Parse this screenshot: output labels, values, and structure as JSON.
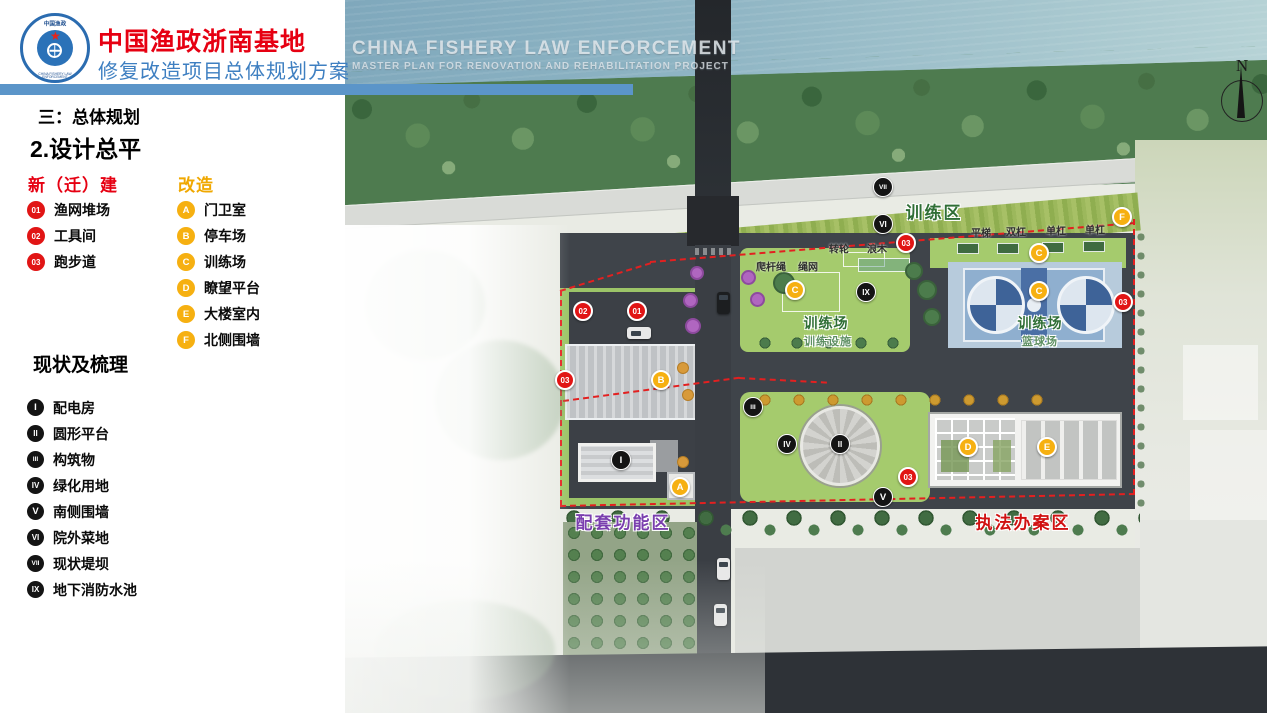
{
  "header": {
    "title": "中国渔政浙南基地",
    "subtitle": "修复改造项目总体规划方案",
    "watermark_line1": "CHINA FISHERY LAW ENFORCEMENT",
    "watermark_line2": "MASTER PLAN FOR RENOVATION AND REHABILITATION PROJECT",
    "logo": {
      "top_text": "中国渔政",
      "bottom_text": "CHINA FISHERY LAW ENFORCEMENT"
    }
  },
  "sidebar": {
    "section_label": "三：总体规划",
    "page_title": "2.设计总平",
    "legend_new": {
      "title": "新（迁）建",
      "items": [
        {
          "id": "01",
          "label": "渔网堆场"
        },
        {
          "id": "02",
          "label": "工具间"
        },
        {
          "id": "03",
          "label": "跑步道"
        }
      ]
    },
    "legend_renovation": {
      "title": "改造",
      "items": [
        {
          "id": "A",
          "label": "门卫室"
        },
        {
          "id": "B",
          "label": "停车场"
        },
        {
          "id": "C",
          "label": "训练场"
        },
        {
          "id": "D",
          "label": "瞭望平台"
        },
        {
          "id": "E",
          "label": "大楼室内"
        },
        {
          "id": "F",
          "label": "北侧围墙"
        }
      ]
    },
    "legend_existing": {
      "title": "现状及梳理",
      "items": [
        {
          "id": "I",
          "label": "配电房"
        },
        {
          "id": "II",
          "label": "圆形平台"
        },
        {
          "id": "III",
          "label": "构筑物"
        },
        {
          "id": "IV",
          "label": "绿化用地"
        },
        {
          "id": "V",
          "label": "南侧围墙"
        },
        {
          "id": "VI",
          "label": "院外菜地"
        },
        {
          "id": "VII",
          "label": "现状堤坝"
        },
        {
          "id": "IX",
          "label": "地下消防水池"
        }
      ]
    }
  },
  "map": {
    "compass_label": "N",
    "zone_labels": [
      {
        "text": "训练区",
        "x": 589,
        "y": 211,
        "type": "zone-green"
      },
      {
        "text": "训练场",
        "x": 481,
        "y": 323,
        "type": "area-green"
      },
      {
        "text": "训练设施",
        "x": 483,
        "y": 341,
        "type": "area-sub"
      },
      {
        "text": "训练场",
        "x": 695,
        "y": 323,
        "type": "area-green"
      },
      {
        "text": "篮球场",
        "x": 695,
        "y": 341,
        "type": "area-sub"
      },
      {
        "text": "配套功能区",
        "x": 278,
        "y": 521,
        "type": "zone-purple"
      },
      {
        "text": "执法办案区",
        "x": 678,
        "y": 521,
        "type": "zone-red"
      }
    ],
    "equipment_labels": [
      {
        "text": "爬杆绳",
        "x": 426,
        "y": 266
      },
      {
        "text": "绳网",
        "x": 463,
        "y": 266
      },
      {
        "text": "转轮",
        "x": 494,
        "y": 248
      },
      {
        "text": "浪木",
        "x": 532,
        "y": 248
      },
      {
        "text": "平梯",
        "x": 636,
        "y": 232
      },
      {
        "text": "双杠",
        "x": 671,
        "y": 231
      },
      {
        "text": "单杠",
        "x": 711,
        "y": 230
      },
      {
        "text": "单杠",
        "x": 750,
        "y": 229
      }
    ],
    "markers": [
      {
        "id": "02",
        "type": "red",
        "x": 238,
        "y": 311
      },
      {
        "id": "01",
        "type": "red",
        "x": 292,
        "y": 311
      },
      {
        "id": "03",
        "type": "red",
        "x": 220,
        "y": 380
      },
      {
        "id": "03",
        "type": "red",
        "x": 561,
        "y": 243
      },
      {
        "id": "03",
        "type": "red",
        "x": 778,
        "y": 302
      },
      {
        "id": "03",
        "type": "red",
        "x": 563,
        "y": 477
      },
      {
        "id": "A",
        "type": "yellow",
        "x": 335,
        "y": 487
      },
      {
        "id": "B",
        "type": "yellow",
        "x": 316,
        "y": 380
      },
      {
        "id": "C",
        "type": "yellow",
        "x": 450,
        "y": 290
      },
      {
        "id": "C",
        "type": "yellow",
        "x": 694,
        "y": 253
      },
      {
        "id": "C",
        "type": "yellow",
        "x": 694,
        "y": 291
      },
      {
        "id": "D",
        "type": "yellow",
        "x": 623,
        "y": 447
      },
      {
        "id": "E",
        "type": "yellow",
        "x": 702,
        "y": 447
      },
      {
        "id": "F",
        "type": "yellow",
        "x": 777,
        "y": 217
      },
      {
        "id": "I",
        "type": "black",
        "x": 276,
        "y": 460
      },
      {
        "id": "II",
        "type": "black",
        "x": 495,
        "y": 444
      },
      {
        "id": "III",
        "type": "black",
        "x": 408,
        "y": 407
      },
      {
        "id": "IV",
        "type": "black",
        "x": 442,
        "y": 444
      },
      {
        "id": "V",
        "type": "black",
        "x": 538,
        "y": 497
      },
      {
        "id": "VI",
        "type": "black",
        "x": 538,
        "y": 224
      },
      {
        "id": "VII",
        "type": "black",
        "x": 538,
        "y": 187
      },
      {
        "id": "IX",
        "type": "black",
        "x": 521,
        "y": 292
      }
    ]
  }
}
